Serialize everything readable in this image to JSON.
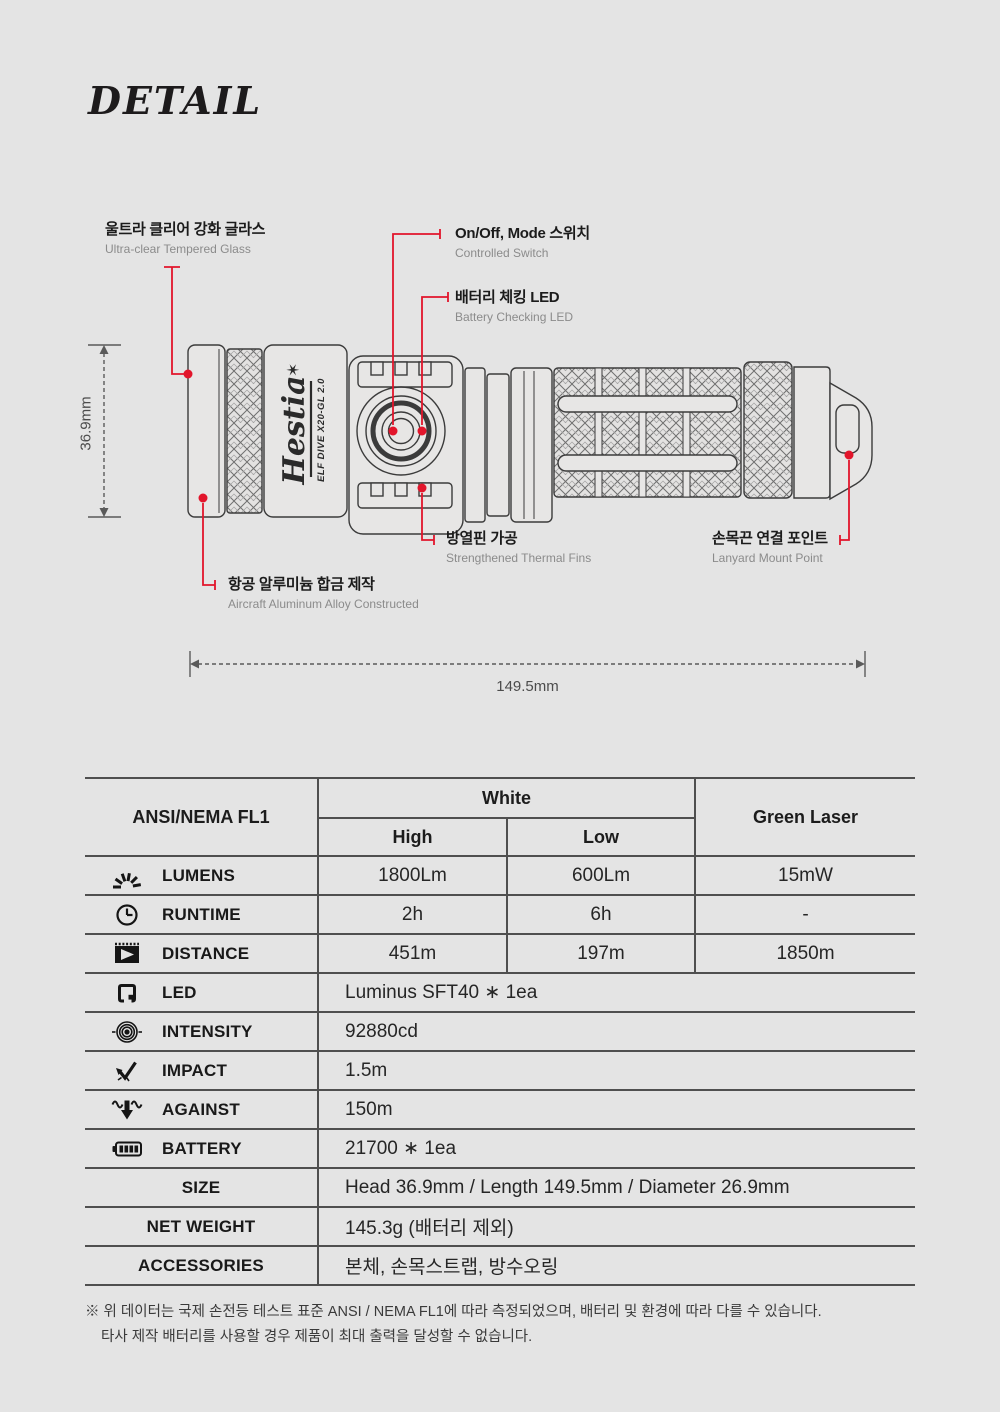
{
  "colors": {
    "red": "#e2152b",
    "bg": "#e4e4e4",
    "line": "#3b3b3b",
    "table_line": "#4f4f4f"
  },
  "title": "DETAIL",
  "product": {
    "logo": "Hestia",
    "logo_star": "✶",
    "model": "ELF DIVE X20-GL 2.0"
  },
  "dimensions": {
    "height": "36.9mm",
    "length": "149.5mm"
  },
  "callouts": {
    "tempered_glass": {
      "ko": "울트라 클리어 강화 글라스",
      "en": "Ultra-clear Tempered Glass"
    },
    "mode_switch": {
      "ko": "On/Off, Mode 스위치",
      "en": "Controlled Switch"
    },
    "battery_led": {
      "ko": "배터리 체킹 LED",
      "en": "Battery Checking LED"
    },
    "thermal_fins": {
      "ko": "방열핀 가공",
      "en": "Strengthened Thermal Fins"
    },
    "aluminum": {
      "ko": "항공 알루미늄 합금 제작",
      "en": "Aircraft Aluminum Alloy Constructed"
    },
    "lanyard": {
      "ko": "손목끈 연결 포인트",
      "en": "Lanyard Mount Point"
    }
  },
  "spec_table": {
    "header": {
      "standard": "ANSI/NEMA FL1",
      "white": "White",
      "high": "High",
      "low": "Low",
      "green_laser": "Green Laser"
    },
    "lumens": {
      "label": "LUMENS",
      "high": "1800Lm",
      "low": "600Lm",
      "laser": "15mW"
    },
    "runtime": {
      "label": "RUNTIME",
      "high": "2h",
      "low": "6h",
      "laser": "-"
    },
    "distance": {
      "label": "DISTANCE",
      "high": "451m",
      "low": "197m",
      "laser": "1850m"
    },
    "led": {
      "label": "LED",
      "value": "Luminus SFT40 ∗ 1ea"
    },
    "intensity": {
      "label": "INTENSITY",
      "value": "92880cd"
    },
    "impact": {
      "label": "IMPACT",
      "value": "1.5m"
    },
    "against": {
      "label": "AGAINST",
      "value": "150m"
    },
    "battery": {
      "label": "BATTERY",
      "value": "21700 ∗ 1ea"
    },
    "size": {
      "label": "SIZE",
      "value": "Head 36.9mm / Length 149.5mm / Diameter 26.9mm"
    },
    "net_weight": {
      "label": "NET WEIGHT",
      "value": "145.3g (배터리 제외)"
    },
    "accessories": {
      "label": "ACCESSORIES",
      "value": "본체, 손목스트랩, 방수오링"
    }
  },
  "footnote": {
    "line1": "※ 위 데이터는 국제 손전등 테스트 표준 ANSI / NEMA FL1에 따라 측정되었으며, 배터리 및 환경에 따라 다를 수 있습니다.",
    "line2": "타사 제작 배터리를 사용할 경우 제품이 최대 출력을 달성할 수 없습니다."
  }
}
